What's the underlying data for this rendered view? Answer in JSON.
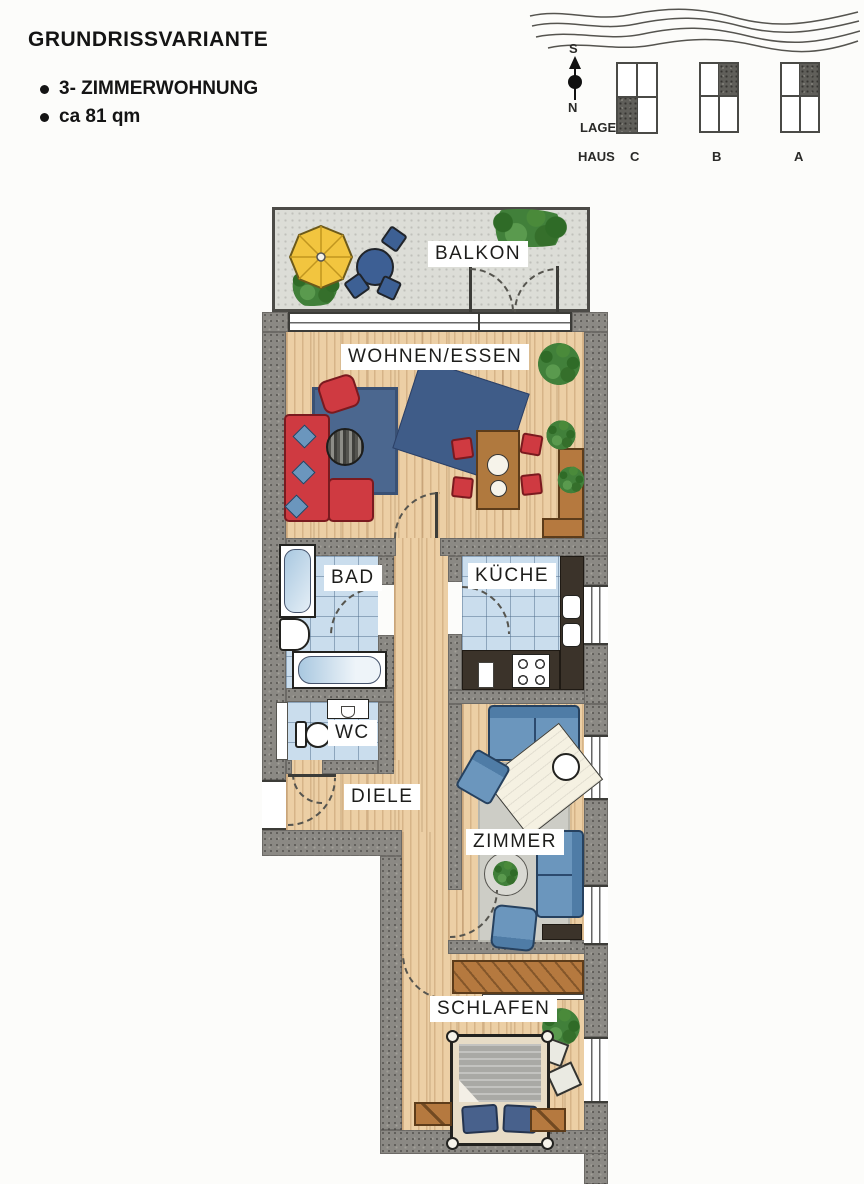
{
  "header": {
    "title": "GRUNDRISSVARIANTE",
    "bullets": [
      "3- ZIMMERWOHNUNG",
      "ca 81 qm"
    ]
  },
  "legend": {
    "compass": {
      "south": "S",
      "north": "N"
    },
    "lage_label": "LAGE",
    "haus_label": "HAUS",
    "houses": [
      {
        "name": "C",
        "shaded_quadrant": "bottom-left"
      },
      {
        "name": "B",
        "shaded_quadrant": "top-right"
      },
      {
        "name": "A",
        "shaded_quadrant": "top-right"
      }
    ],
    "water_icon": "wavy-lines"
  },
  "rooms": {
    "balkon": {
      "label": "BALKON"
    },
    "wohnen": {
      "label": "WOHNEN/ESSEN"
    },
    "bad": {
      "label": "BAD"
    },
    "kueche": {
      "label": "KÜCHE"
    },
    "wc": {
      "label": "WC"
    },
    "diele": {
      "label": "DIELE"
    },
    "zimmer": {
      "label": "ZIMMER"
    },
    "schlafen": {
      "label": "SCHLAFEN"
    }
  },
  "colors": {
    "wall": "#8b8984",
    "wood_floor": "#eccfa5",
    "tile_floor": "#cadded",
    "balcony_floor": "#dcddd7",
    "sofa_red": "#cf3a41",
    "furniture_blue": "#6b96bd",
    "rug_blue": "#4b678f",
    "umbrella_yellow": "#f2c53f",
    "plant_green": "#41803a",
    "wood_furniture": "#b5793f",
    "counter_dark": "#3b332a"
  }
}
